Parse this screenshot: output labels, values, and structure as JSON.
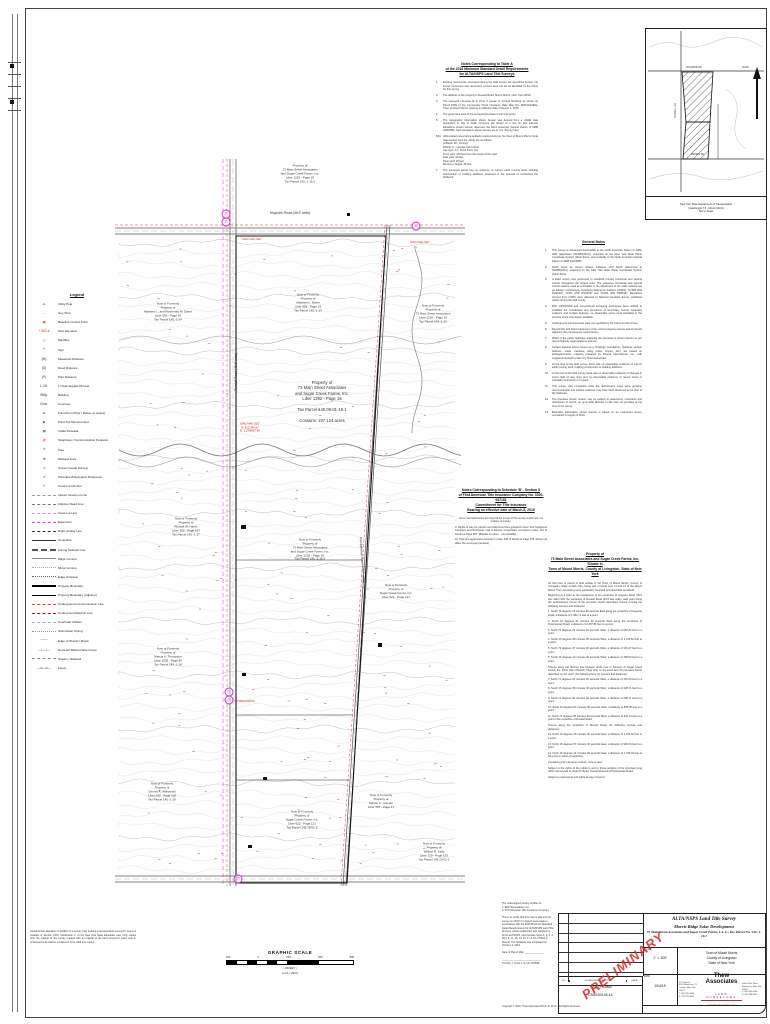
{
  "tableA": {
    "heading": [
      "Notes Corresponding to Table A",
      "of the 2016 Minimum Standard Detail Requirements",
      "for ALTA/NSPS Land Title Surveys"
    ],
    "items": [
      {
        "n": "1.",
        "t": "Existing monuments recovered during the field survey are described hereon. No corner monument was recovered; corners were not set as identified by the Client for this survey."
      },
      {
        "n": "2.",
        "t": "The address of the property is Russell Road, Mount Morris, New York 14510."
      },
      {
        "n": "3.",
        "t": "The surveyed premises lie in Zone X (areas of minimal flooding) as shown on Panel 181E of the Community Flood Insurance Rate Map No. 36051C0181E, Town of Mount Morris, bearing an effective date of August 2, 1978."
      },
      {
        "n": "4.",
        "t": "The gross land area of the surveyed premises is 197.124 acres."
      },
      {
        "n": "5.",
        "t": "The topographic information shown hereon was derived from a LiDAR data acquisition in July of 2018. Contours are shown at a one (1) foot interval. Elevations shown hereon reference the North American Vertical Datum of 1988 (NAVD88). Spot elevations shown hereon are in U.S. Survey Feet."
      },
      {
        "n": "6(b).",
        "t": "Abbreviated notes listing setback requirements per the Town of Mount Morris Code (last revised June 21, 2012) are as follows:\n(Chapter 98 - Zoning)\nDistrict 'A' - Upstate Farm Zone\nUse type: A-1, Rural Farm Use\nFront yard: 100 feet from the center of the road\nSide yard: 30 feet\nRear yard: 30 feet\nMaximum height: 35 feet"
      },
      {
        "n": "7.",
        "t": "The surveyed parcel has no evidence of current earth moving work, building construction or building additions observed in the process of conducting the fieldwork."
      }
    ]
  },
  "generalNotes": {
    "heading": "General Notes",
    "items": [
      {
        "n": "1.",
        "t": "This survey is referenced horizontally to the North American Datum of 1983, 2011 adjustment (NAD83(2011)), projected on the New York State Plane Coordinate System (West Zone), and vertically to the North American Vertical Datum of 1988 (NAVD88)."
      },
      {
        "n": "2.",
        "t": "North arrow as shown hereon indicates Grid North referenced to NAD83(2011), projected on the New York State Plane Coordinate System (West Zone)."
      },
      {
        "n": "3.",
        "t": "A static survey was performed to establish primary horizontal and vertical control throughout the project area. The reference horizontal and vertical control stations used as a baseline in the adjustment of the static network are as follows: Continuously Operating Reference Stations (CORS): 'NYRM (PID DH4243)', 'NYPF (PID DG5678)' and 'NYHM (PID DF8343)'. Elevations derived from CORS were adjusted to National Geodetic Survey published values during the field survey."
      },
      {
        "n": "4.",
        "t": "RTK GPS/GNSS and conventional surveying techniques were utilized to establish the coordinates and elevations of secondary control, boundary evidence and surface features; no observable errors were identified in the process of the information available."
      },
      {
        "n": "5.",
        "t": "Underground improvements were not specified by the Client for this survey."
      },
      {
        "n": "6.",
        "t": "Record title and deed references of the current property owners and of parcels adjoining the premises are noted hereon."
      },
      {
        "n": "7.",
        "t": "Width of the public highways adjoining the premises is shown hereon as per record highway appropriations and use."
      },
      {
        "n": "8.",
        "t": "Surface features shown hereon (e.g. buildings, foundations, hydrants, surface features, roads, treelines, utility poles, fences, etc.) are based on photogrammetric mapping prepared by Kucera International, Inc., with supplemental field location by Thew Associates."
      },
      {
        "n": "9.",
        "t": "At the time of the field survey there was no observable evidence of current earth moving work, building construction or building additions."
      },
      {
        "n": "10.",
        "t": "At the time of the field survey there was no observable evidence of changes in street right of way lines and no observable evidence of recent street or sidewalk construction or repairs."
      },
      {
        "n": "11.",
        "t": "This survey was completed while the landowner's crops were growing; monumentation and surface evidence may have been obscured at the time of the fieldwork."
      },
      {
        "n": "12.",
        "t": "The premises shown hereon may be subject to easements, covenants and restrictions of record; an up-to-date abstract of title was not provided at the time of the survey."
      },
      {
        "n": "13.",
        "t": "Boundary information shown hereon is based on an instrument survey completed in August of 2019."
      }
    ]
  },
  "schedB": {
    "heading": [
      "Notes Corresponding to Schedule 'B' - Section II",
      "of First American Title Insurance Company No. 3020-937181",
      "Commitment for Title Insurance",
      "Bearing an effective date of March 8, 2019"
    ],
    "note": "Items not listed below are beyond the scope of this survey and/or are not matters of survey.",
    "items": [
      {
        "t": "9. Rights of way for electric and telephone lines granted to New York Telephone Company and Rochester Gas & Electric Corporation recorded in Liber 234 of Deeds at Page 567. (Blanket in nature - not plottable)"
      },
      {
        "t": "10. Pipe line agreement recorded in Liber 345 of Deeds at Page 678. (Does not affect the surveyed premises)"
      }
    ]
  },
  "description": {
    "title": [
      "Property of",
      "73 Main Street Associates and Sugar Creek Farms, Inc.",
      "Situate in",
      "Town of Mount Morris, County of Livingston, State of New York"
    ],
    "paras": [
      {
        "t": "All that tract or parcel of land situate in the Town of Mount Morris, County of Livingston, State of New York, being part of Great Lots 13 and 14 of the Mount Morris Tract, and being more particularly bounded and described as follows:"
      },
      {
        "t": "Beginning at a point at the intersection of the centerline of Hogmire Road (49.5 feet wide) with the centerline of Russell Road (49.5 feet wide), said point being the northwesterly corner of the premises herein described; thence running the following courses and distances:"
      },
      {
        "t": "1. South 74 degrees 19 minutes 30 seconds East along the centerline of Hogmire Road, a distance of 1,482.71 feet to a point;"
      },
      {
        "t": "2. South 16 degrees 41 minutes 00 seconds West along the centerline of Presbyterian Road, a distance of 2,297.86 feet to a point;"
      },
      {
        "t": "3. North 74 degrees 23 minutes 30 seconds West, a distance of 663.42 feet to a point;"
      },
      {
        "t": "4. South 15 degrees 58 minutes 00 seconds West, a distance of 1,016.50 feet to a point;"
      },
      {
        "t": "5. North 73 degrees 47 minutes 30 seconds West, a distance of 331.27 feet to a point;"
      },
      {
        "t": "6. South 16 degrees 12 minutes 30 seconds West, a distance of 495.00 feet to a point;"
      },
      {
        "t": "Thence along the division line between lands now or formerly of Sugar Creek Farms, Inc. (Liber 622 of Deeds, Page 121) on the south and the premises herein described on the north, the following three (3) courses and distances:"
      },
      {
        "t": "7. North 74 degrees 02 minutes 00 seconds West, a distance of 425.00 feet to a point;"
      },
      {
        "t": "8. South 15 degrees 58 minutes 00 seconds West, a distance of 208.71 feet to a point;"
      },
      {
        "t": "9. North 74 degrees 02 minutes 00 seconds West, a distance of 208.71 feet to a point;"
      },
      {
        "t": "10. South 16 degrees 04 minutes 30 seconds West, a distance of 686.38 feet to a point;"
      },
      {
        "t": "11. North 73 degrees 55 minutes 30 seconds West, a distance of 331.10 feet to a point in the centerline of Russell Road;"
      },
      {
        "t": "Thence along the centerline of Russell Road, the following courses and distances:"
      },
      {
        "t": "12. North 16 degrees 08 minutes 00 seconds East, a distance of 1,155.62 feet to a point;"
      },
      {
        "t": "13. North 15 degrees 57 minutes 30 seconds East, a distance of 990.00 feet to a point;"
      },
      {
        "t": "14. North 16 degrees 11 minutes 00 seconds East, a distance of 1,733.93 feet to the point or place of beginning."
      },
      {
        "t": "Containing 197.124 acres of land, more or less."
      },
      {
        "t": "Subject to the rights of the public in and to those portions of the premises lying within the bounds of Hogmire Road, Russell Road and Presbyterian Road."
      },
      {
        "t": "Subject to easements and rights-of-way of record."
      }
    ]
  },
  "legend": {
    "title": "Legend",
    "items": [
      {
        "g": "-●-",
        "gc": "#cc2222",
        "label": "Utility Pole"
      },
      {
        "g": "→",
        "gc": "#cc2222",
        "label": "Guy Wire"
      },
      {
        "g": "▣",
        "gc": "#cc2222",
        "label": "Baseline Control Point"
      },
      {
        "g": "+ 582.4",
        "gc": "#cc2222",
        "label": "Spot Elevation"
      },
      {
        "g": "◻",
        "gc": "#333333",
        "label": "Mail Box"
      },
      {
        "g": "⊢",
        "gc": "#333333",
        "label": "Sign"
      },
      {
        "g": "(M)",
        "gc": "#333333",
        "label": "Measured Distance"
      },
      {
        "g": "(D)",
        "gc": "#333333",
        "label": "Deed Distance"
      },
      {
        "g": "(P)",
        "gc": "#333333",
        "label": "Plan Distance"
      },
      {
        "g": "1 CH.",
        "gc": "#333333",
        "label": "1 Chain Equals 66 Feet"
      },
      {
        "g": "Bldg.",
        "gc": "#333333",
        "label": "Building"
      },
      {
        "g": "Conc.",
        "gc": "#333333",
        "label": "Concrete"
      },
      {
        "g": "●",
        "gc": "#111111",
        "label": "Found Iron (Pipe / Rebar, et cetera)"
      },
      {
        "g": "■",
        "gc": "#111111",
        "label": "Point Not Monumented"
      },
      {
        "g": "▤",
        "gc": "#111111",
        "label": "Cable Pedestal"
      },
      {
        "g": "▥",
        "gc": "#cc2222",
        "label": "Telephone / Communication Pedestal"
      },
      {
        "g": "✳",
        "gc": "#333333",
        "label": "Tree"
      },
      {
        "g": "❖",
        "gc": "#333333",
        "label": "Wetland Area"
      },
      {
        "g": "⊃",
        "gc": "#333333",
        "label": "Culvert (Aerial Survey)"
      },
      {
        "g": "⑧",
        "gc": "#cc33cc",
        "label": "Schedule B Exception Reference"
      },
      {
        "g": "5",
        "gc": "#cc33cc",
        "label": "Great Lot Number"
      },
      {
        "ln": "1px dashed #999999",
        "label": "Interior Great Lot Line"
      },
      {
        "ln": "1px dashed #777777",
        "label": "Adjoiner Deed Line"
      },
      {
        "ln": "1px dashed #ee88cc",
        "label": "Great Lot Line"
      },
      {
        "ln": "1px dashed #dd44dd",
        "label": "Easement"
      },
      {
        "ln": "1px dashed #333333",
        "label": "Right-of-Way Line"
      },
      {
        "ln": "1px solid #333333",
        "label": "Centerline"
      },
      {
        "ln": "2px dashed #555555",
        "label": "Zoning Setback Line"
      },
      {
        "ln": "1px solid #888888",
        "label": "Major Contour"
      },
      {
        "ln": "1px dotted #aaaaaa",
        "label": "Minor Contour"
      },
      {
        "ln": "1px dotted #666666",
        "label": "Edge of Gravel"
      },
      {
        "ln": "2px solid #000000",
        "label": "Property Boundary"
      },
      {
        "ln": "1px solid #000000",
        "label": "Property Boundary (Adjoiner)"
      },
      {
        "ln": "1px dashed #cc4444",
        "label": "Underground Communication Line"
      },
      {
        "ln": "1px dashed #cc0000",
        "label": "Underground Electric Line"
      },
      {
        "ln": "1px dashed #aaaaaa",
        "label": "Overhead Utilities"
      },
      {
        "ln": "1px dotted #999999",
        "label": "Stormwater Piping"
      },
      {
        "g": "ᴖᴖᴖᴖ",
        "gc": "#777777",
        "label": "Edge of Woods / Brush"
      },
      {
        "g": "—x—x—",
        "gc": "#777777",
        "label": "Remnant Barbed Wire Fence"
      },
      {
        "ln": "1px dashed #8899aa",
        "label": "Stream / Wetland"
      },
      {
        "g": "—o—o—",
        "gc": "#333333",
        "label": "Fence"
      }
    ]
  },
  "map": {
    "labels": [
      {
        "x": 300,
        "y": 174,
        "t": "Property of\n73 Main Street Associates\nand Sugar Creek Farms, Inc.\nLiber 1292 - Page 18\nTax Parcel 145.-1-15.2"
      },
      {
        "x": 290,
        "y": 213,
        "t": "Hogmire Road  (49.5' wide)",
        "fs": 3.4,
        "it": 1
      },
      {
        "x": 168,
        "y": 312,
        "w": 62,
        "t": "Now or Formerly\nProperty of\nMatthew L. and Rosemary M. Dieter\nLiber 556 - Page 16\nTax Parcel 145.-1-14"
      },
      {
        "x": 308,
        "y": 303,
        "t": "Now or Formerly\nProperty of\nMatthew L. Dieter\nLiber 556 - Page 16\nTax Parcel 145.-1-13"
      },
      {
        "x": 433,
        "y": 314,
        "t": "Now or Formerly\nProperty of\n73 Main Street Associates\nLiber 1292 - Page 18\nTax Parcel 145.-1-10"
      },
      {
        "x": 322,
        "y": 402,
        "fs": 4.2,
        "t": "Property of\n73 Main Street Associates\nand Sugar Creek Farms, Inc.\nLiber 1292 - Page 18\n\nTax Parcel 145.09-01-16.1\n\nContains: 197.124 acres"
      },
      {
        "x": 250,
        "y": 428,
        "c": "#cc2222",
        "fs": 2.8,
        "t": "MAG NAIL SET\nN: 812,345.67\nE: 1,234,567.89"
      },
      {
        "x": 252,
        "y": 240,
        "c": "#cc2222",
        "fs": 2.8,
        "t": "MAG NAIL SET"
      },
      {
        "x": 420,
        "y": 243,
        "c": "#cc2222",
        "fs": 2.8,
        "t": "MAG NAIL SET"
      },
      {
        "x": 186,
        "y": 527,
        "t": "Now or Formerly\nProperty of\nRussell W. Harris\nLiber 305 - Page 187\nTax Parcel 145.-1-17"
      },
      {
        "x": 310,
        "y": 550,
        "t": "Now or Formerly\nProperty of\n73 Main Street Associates\nand Sugar Creek Farms, Inc.\nLiber 1292 - Page 18\nTax Parcel 145.-1-16.2"
      },
      {
        "x": 396,
        "y": 592,
        "t": "Now or Formerly\nProperty of\nSugar Creek Farms, Inc.\nLiber 622 - Page 121"
      },
      {
        "x": 168,
        "y": 657,
        "t": "Now or Formerly\nProperty of\nMarcia A. Thompson\nLiber 1035 - Page 85\nTax Parcel 145.-1-18"
      },
      {
        "x": 240,
        "y": 702,
        "c": "#cc2222",
        "fs": 2.8,
        "t": "POINT OF BEGINNING"
      },
      {
        "x": 162,
        "y": 792,
        "t": "Now or Formerly\nProperty of\nDennis A. Witkowski\nLiber 640 - Page 118\nTax Parcel 145.-1-19"
      },
      {
        "x": 302,
        "y": 820,
        "t": "Now or Formerly\nProperty of\nSugar Creek Farms, Inc.\nLiber 622 - Page 121\nTax Parcel 145.18-01-2"
      },
      {
        "x": 381,
        "y": 802,
        "t": "Now or Formerly\nProperty of\nMarian K. Holman\nLiber 557 - Page 17"
      },
      {
        "x": 434,
        "y": 852,
        "t": "Now or Formerly\nProperty of\nWilliam R. Kelly\nLiber 729 - Page 133\nTax Parcel 145.20-01-1"
      },
      {
        "x": 236,
        "y": 372,
        "rot": -90,
        "fs": 3.4,
        "it": 1,
        "t": "Russell Road  (49.5' wide)"
      },
      {
        "x": 362,
        "y": 560,
        "rot": 86,
        "fs": 3.4,
        "it": 1,
        "t": "Presbyterian Road  (49.5' wide)"
      }
    ],
    "circles": [
      {
        "x": 226,
        "y": 214,
        "n": "10"
      },
      {
        "x": 226,
        "y": 222,
        "n": "11"
      },
      {
        "x": 416,
        "y": 226,
        "n": "12"
      },
      {
        "x": 229,
        "y": 692,
        "n": "13"
      },
      {
        "x": 229,
        "y": 700,
        "n": "14"
      },
      {
        "x": 238,
        "y": 879,
        "n": "15"
      }
    ]
  },
  "inset": {
    "labels": {
      "top_left": "HOGMIRE RD",
      "top_right": "ROAD",
      "bottom": "PERRIN RD",
      "left": "RUSSELL RD"
    },
    "caption": [
      "New York State Department of Transportation",
      "Quadrangle 7.5 - Mount Morris",
      "Not to Scale"
    ]
  },
  "scalebar": {
    "title": "GRAPHIC SCALE",
    "ticks": [
      {
        "t": "200"
      },
      {
        "t": "0"
      },
      {
        "t": "200"
      },
      {
        "t": "400"
      },
      {
        "t": "800"
      }
    ],
    "in_feet": "( IN FEET )",
    "ratio": "1 inch = 200 ft."
  },
  "lawnote": "Unauthorized alteration or addition to a survey map bearing a licensed land surveyor's seal is a violation of Section 7209, Subdivision 2, of the New York State Education Law. Only copies from the original of this survey marked with an original of the land surveyor's inked seal or embossed seal shall be considered to be valid true copies.",
  "certification": "The undersigned hereby certifies to:\n1.  EDF Renewables, Inc.\n2.  First American Title Insurance Company\n\nThis is to certify that this map or plat and the survey on which it is based were made in accordance with the 2016 Minimum Standard Detail Requirements for ALTA/NSPS Land Title Surveys, jointly established and adopted by ALTA and NSPS, and includes Items 1, 2, 3, 4, 6(b), 8, 11, 13, 14, 16, 17 & 19 of Table A thereof. The fieldwork was completed on October 4, 2019.\n\nDate of Plat or Map: ______________\n\n____________________________\nTimothy J. Thew, L.S. No. 050096",
  "titleblock": {
    "stamp": "PRELIMINARY",
    "title_line1": "ALTA/NSPS Land Title Survey",
    "title_line2": "Morris Ridge Solar Development",
    "title_line3": "73 Main Street Associates and Sugar Creek Farms, L.L.C., Tax Parcel No. 145.-1-16.1",
    "location": [
      "Town of Mount Morris",
      "County of Livingston",
      "State of New York"
    ],
    "scale_label": "SCALE",
    "scale_value": "1\" = 200'",
    "date_label": "DATE",
    "date_value": "10/4/19",
    "firm": "Thew Associates",
    "firm_sub": "LAND SURVEYORS",
    "web": "www.ThewAssociates.com",
    "addr_left": "P.O. Box 61\n4051 State Hwy. 11\nCanton, New York 13617\nT: 315-322-4100\nF: 315-322-4101",
    "addr_right": "Office Park West\nWatertown, New York 13601\nT: 315-788-4100\nF: 315-788-4101",
    "project_label": "PROJECT NUMBER",
    "project_number": "CN2040/145-16",
    "rev_headers": [
      "NO.",
      "LOCATION/DESCRIPTION",
      "DATE"
    ],
    "copyright": "Copyright © 2019, Thew Associates PE & LS, PLLC  -  All Rights Reserved"
  },
  "colors": {
    "accent_red": "#cc2222",
    "magenta": "#cc33cc",
    "contour_gray": "#cfcfcf"
  }
}
